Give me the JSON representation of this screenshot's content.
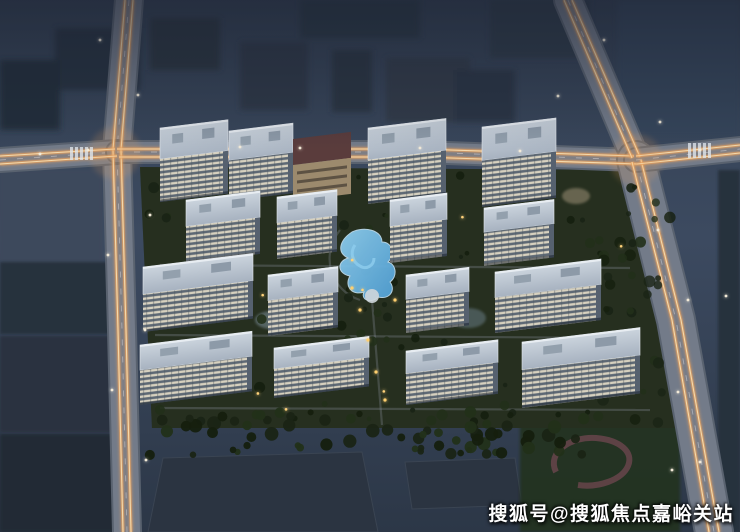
{
  "page": {
    "description": "Aerial night rendering of a residential compound with white high-rise towers, landscaped courtyard, blue pool and glowing road light-trails",
    "watermark": "搜狐号@搜狐焦点嘉峪关站"
  },
  "scene": {
    "colors": {
      "sky_top": "#334052",
      "sky_mid": "#3c4a60",
      "sky_low": "#2c3747",
      "complex_ground_a": "#2c3624",
      "complex_ground_b": "#1f291b",
      "road_base": "#59626f",
      "road_top": "#78808e",
      "trail_glow": "#e9a25f",
      "trail_core": "#f8e0b2",
      "lane_dash": "#e8ecf2",
      "roof_light": "#ccd5de",
      "roof_dark": "#a7b2c0",
      "facade_lit": "#d7d1bf",
      "facade_dark": "#5d6874",
      "tower_side": "#56616f",
      "commercial_wall": "#9c8a6d",
      "commercial_band": "#5a3c3c",
      "pool_main": "#4f9fd4",
      "pool_light": "#8ecdee",
      "tree_a": "#1a2415",
      "tree_b": "#223019",
      "tree_c": "#151f0e",
      "warm_light": "#ffd27a",
      "street_light": "#f3ead8",
      "block_dark": "#27303d",
      "block_mid": "#39465a",
      "warehouse": "#2b3441",
      "track": "#6b464e",
      "field": "#20301f"
    },
    "towers": [
      [
        160,
        128,
        68,
        74
      ],
      [
        229,
        131,
        64,
        70
      ],
      [
        368,
        128,
        78,
        76
      ],
      [
        482,
        127,
        74,
        80
      ],
      [
        186,
        200,
        74,
        63
      ],
      [
        277,
        197,
        60,
        62
      ],
      [
        390,
        200,
        57,
        63
      ],
      [
        484,
        208,
        70,
        58
      ],
      [
        143,
        267,
        110,
        65
      ],
      [
        268,
        275,
        70,
        61
      ],
      [
        406,
        275,
        63,
        58
      ],
      [
        495,
        272,
        106,
        61
      ],
      [
        140,
        345,
        112,
        60
      ],
      [
        274,
        348,
        95,
        50
      ],
      [
        406,
        351,
        92,
        54
      ],
      [
        522,
        342,
        118,
        66
      ]
    ],
    "commercial": [
      293,
      139,
      58,
      62
    ],
    "complex_poly": "140,167 632,170 650,205 670,305 694,428 152,428",
    "roads": [
      {
        "d": "M129,0 L117,150 L122,330 L127,532",
        "w": 26
      },
      {
        "d": "M0,160 L117,152",
        "w": 22
      },
      {
        "d": "M117,152 L420,152 L636,160",
        "w": 20
      },
      {
        "d": "M568,0 L636,160",
        "w": 26
      },
      {
        "d": "M636,160 L676,320 L714,532",
        "w": 36
      },
      {
        "d": "M636,160 L740,149",
        "w": 22
      }
    ],
    "trails": [
      "M125,0 L113,150 L118,330 L123,532",
      "M133,0 L121,150 L126,330 L131,532",
      "M0,156 L115,149",
      "M0,164 L117,156",
      "M117,149 L420,149 L634,156",
      "M119,157 L420,157 L637,164",
      "M564,0 L632,158",
      "M572,0 L640,157",
      "M632,162 L672,320 L709,532",
      "M641,160 L681,320 L719,532",
      "M636,156 L740,145",
      "M637,164 L740,153"
    ],
    "city_blocks": [
      [
        240,
        42,
        68,
        68,
        "#2f3947"
      ],
      [
        332,
        50,
        40,
        62,
        "#2b3542"
      ],
      [
        386,
        58,
        84,
        64,
        "#303b4a"
      ],
      [
        455,
        70,
        60,
        52,
        "#2b3644"
      ],
      [
        150,
        18,
        70,
        52,
        "#2a3441"
      ],
      [
        55,
        28,
        85,
        62,
        "#273240"
      ],
      [
        490,
        0,
        100,
        58,
        "#2e3a49"
      ],
      [
        618,
        0,
        122,
        138,
        "#36455a"
      ],
      [
        0,
        60,
        60,
        70,
        "#242e3b"
      ],
      [
        300,
        0,
        120,
        38,
        "#2c3745"
      ]
    ],
    "ground_blocks": [
      [
        0,
        170,
        102,
        92,
        "#3d4a5c"
      ],
      [
        0,
        262,
        112,
        72,
        "#27303d"
      ],
      [
        0,
        336,
        118,
        96,
        "#2a3340"
      ],
      [
        0,
        434,
        116,
        98,
        "#222b36"
      ],
      [
        718,
        170,
        22,
        362,
        "#26303d"
      ]
    ],
    "warehouses": [
      "163,458 362,452 378,532 148,532",
      "405,462 515,458 522,505 412,509"
    ],
    "field_rect": [
      520,
      415,
      160,
      117
    ],
    "track_path": "M556,472 C546,452 572,436 596,438 C620,440 634,452 628,466 C622,480 598,488 578,485",
    "pool_path": "M352,232 C340,240 336,252 348,258 C336,262 338,274 350,276 C344,286 352,296 364,292 C360,300 372,304 378,297 C390,300 396,290 390,282 C398,276 396,264 388,262 C396,254 392,242 382,242 C382,230 364,226 352,232 Z",
    "ponds": [
      {
        "cx": 272,
        "cy": 320,
        "rx": 17,
        "ry": 9,
        "fill": "#8fa4b4",
        "o": 0.45
      },
      {
        "cx": 468,
        "cy": 318,
        "rx": 18,
        "ry": 10,
        "fill": "#7f96a8",
        "o": 0.4
      },
      {
        "cx": 576,
        "cy": 196,
        "rx": 14,
        "ry": 8,
        "fill": "#a89a7f",
        "o": 0.5
      }
    ],
    "street_lights": [
      [
        100,
        40
      ],
      [
        138,
        95
      ],
      [
        88,
        150
      ],
      [
        40,
        154
      ],
      [
        150,
        215
      ],
      [
        108,
        255
      ],
      [
        145,
        330
      ],
      [
        112,
        390
      ],
      [
        146,
        460
      ],
      [
        604,
        40
      ],
      [
        558,
        96
      ],
      [
        660,
        122
      ],
      [
        700,
        150
      ],
      [
        658,
        230
      ],
      [
        688,
        300
      ],
      [
        726,
        296
      ],
      [
        678,
        392
      ],
      [
        700,
        462
      ],
      [
        300,
        148
      ],
      [
        420,
        148
      ],
      [
        520,
        151
      ],
      [
        240,
        147
      ],
      [
        672,
        470
      ]
    ]
  }
}
